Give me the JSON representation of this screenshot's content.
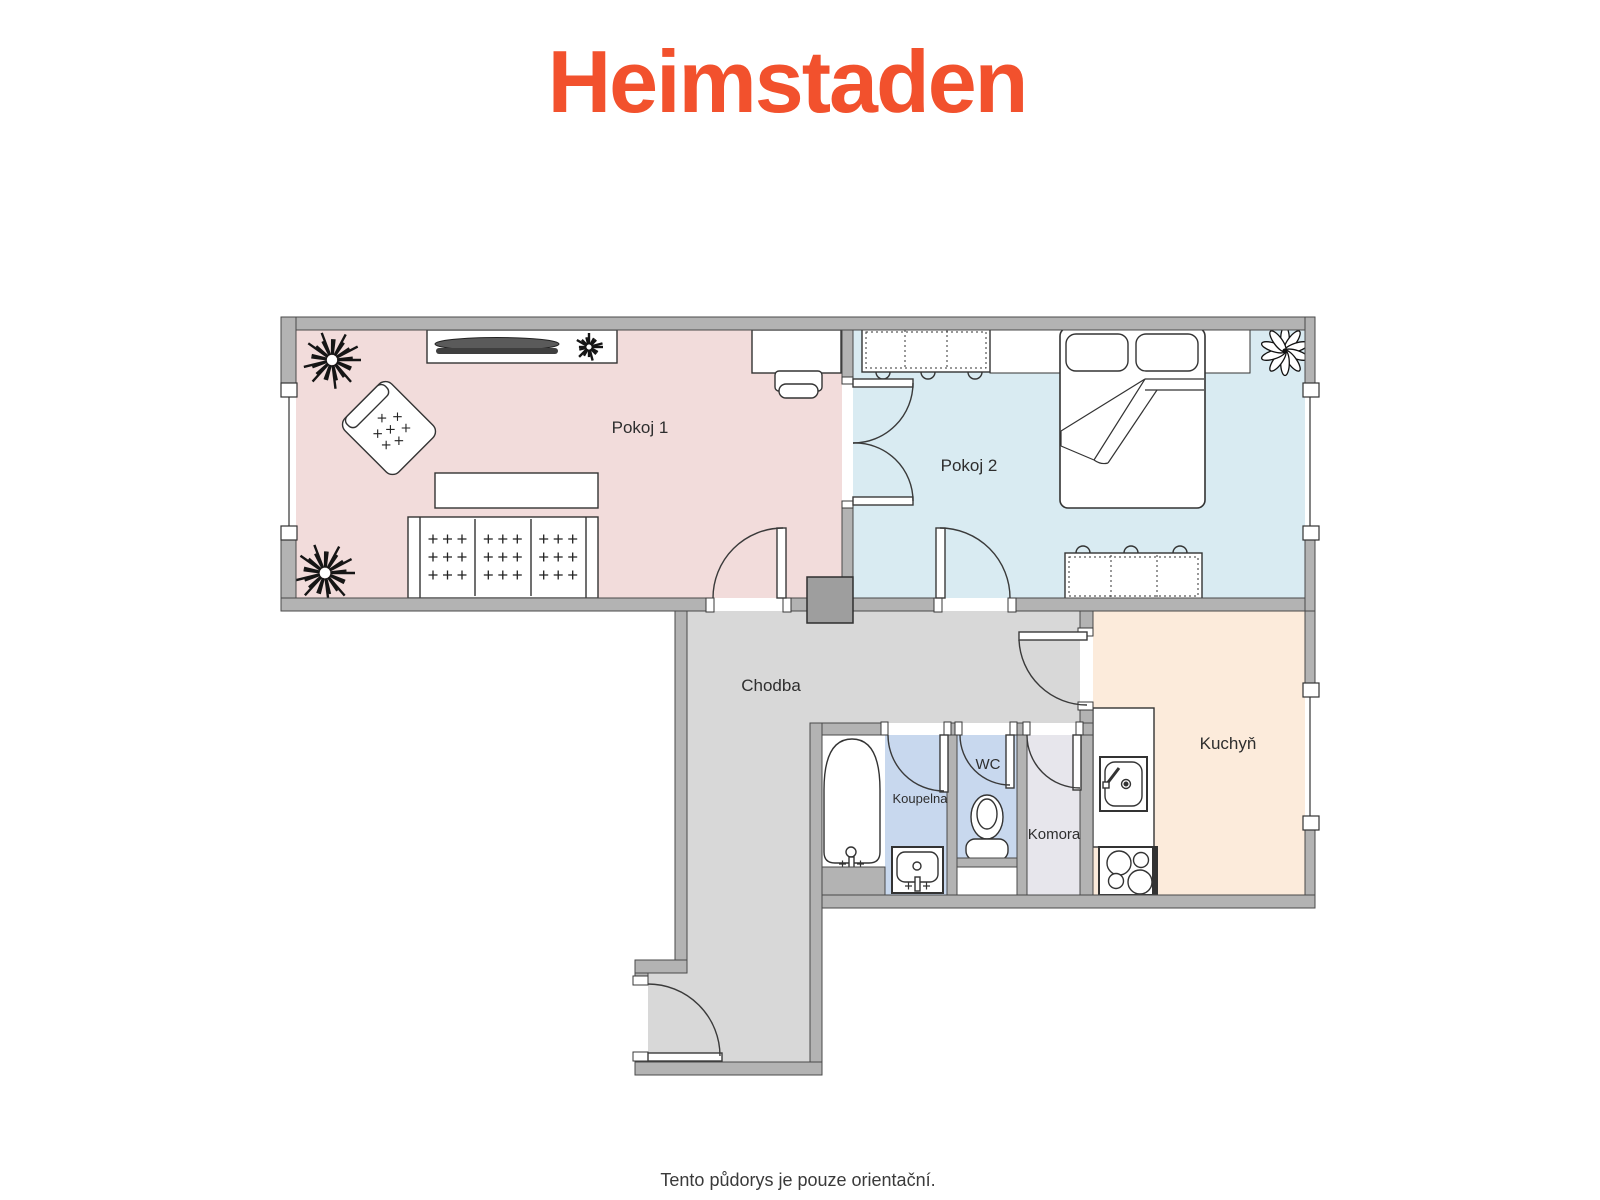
{
  "brand": {
    "logo_text": "Heimstaden",
    "logo_color": "#F2512D"
  },
  "footer": {
    "disclaimer": "Tento půdorys je pouze orientační."
  },
  "floorplan": {
    "wall_color": "#B3B3B3",
    "wall_outline": "#4A4A4A",
    "column_color": "#9E9E9E",
    "rooms": [
      {
        "id": "pokoj1",
        "label": "Pokoj 1",
        "floor_color": "#F2DCDB"
      },
      {
        "id": "pokoj2",
        "label": "Pokoj 2",
        "floor_color": "#D9EBF2"
      },
      {
        "id": "chodba",
        "label": "Chodba",
        "floor_color": "#D8D8D8"
      },
      {
        "id": "kuchyn",
        "label": "Kuchyň",
        "floor_color": "#FCEBDB"
      },
      {
        "id": "koupelna",
        "label": "Koupelna",
        "floor_color": "#C8D8EE"
      },
      {
        "id": "wc",
        "label": "WC",
        "floor_color": "#C8D8EE"
      },
      {
        "id": "komora",
        "label": "Komora",
        "floor_color": "#E7E6EC"
      }
    ]
  }
}
